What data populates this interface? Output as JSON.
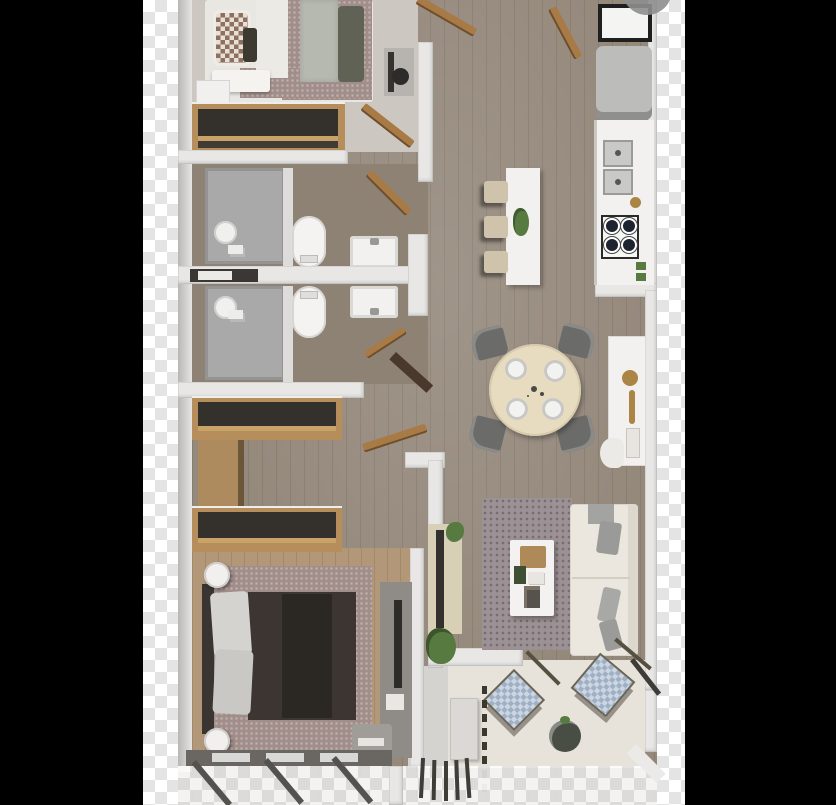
{
  "scene": {
    "type": "3d-floor-plan-render",
    "description": "Top-down 3D rendered apartment floor plan on transparent background with checkerboard edge strips",
    "rooms": [
      {
        "name": "bedroom-top",
        "furniture": [
          "double-bed",
          "checkered-pillow",
          "throw-blanket",
          "nightstand",
          "foot-bench",
          "tv-desk",
          "open-wardrobe"
        ]
      },
      {
        "name": "bathroom-1",
        "furniture": [
          "shower",
          "toilet",
          "vanity-sink",
          "towel-niche"
        ]
      },
      {
        "name": "bathroom-2",
        "furniture": [
          "shower",
          "toilet",
          "vanity-sink"
        ]
      },
      {
        "name": "kitchen",
        "furniture": [
          "fridge",
          "double-sink",
          "gas-hob-4-burners",
          "counter",
          "island",
          "bar-stool",
          "bar-stool",
          "bar-stool",
          "plant"
        ]
      },
      {
        "name": "dining",
        "furniture": [
          "round-table",
          "chair",
          "chair",
          "chair",
          "chair",
          "place-setting-x4"
        ]
      },
      {
        "name": "study-nook",
        "furniture": [
          "desk",
          "table-lamp",
          "chair"
        ]
      },
      {
        "name": "living-room",
        "furniture": [
          "l-shaped-sofa",
          "gray-throws",
          "rug",
          "coffee-table",
          "tv-console",
          "plants"
        ]
      },
      {
        "name": "bedroom-bottom",
        "furniture": [
          "double-bed",
          "bedposts",
          "open-wardrobe",
          "open-wardrobe",
          "dresser",
          "media-unit",
          "stool"
        ]
      },
      {
        "name": "balcony",
        "furniture": [
          "lounge-chair",
          "lounge-chair",
          "round-planter",
          "console-table"
        ]
      }
    ],
    "overlays": [
      "gray-circle-top-right",
      "checkerboard-strip-left",
      "checkerboard-strip-right",
      "shadow-legs-bottom"
    ]
  },
  "palette": {
    "background": "#000000",
    "wood": "#95897c",
    "wood_warm": "#b29878",
    "wall": "#e8e7e5",
    "wall_shade": "#c6c4c2",
    "bedroom1_floor": "#cdc7c1",
    "bathroom_tile": "#a9a9a9",
    "balcony_floor": "#e7e3da",
    "entry_floor": "#d5d3cf",
    "sofa": "#ebe7de",
    "rug": "#9c9194",
    "table": "#e7dcc0",
    "chair_dark": "#6b6b69",
    "wood_furniture": "#b68e5c",
    "door_wood": "#a87a46",
    "closet_interior": "#34302c",
    "accent_green": "#567a40",
    "accent_gold": "#ab8544",
    "blanket_mauve": "#a18d89",
    "duvet_dark": "#3c3531",
    "appliance_white": "#f2f1ef",
    "fridge_gray": "#bcbcba",
    "circle_overlay": "#8e8e8e"
  }
}
